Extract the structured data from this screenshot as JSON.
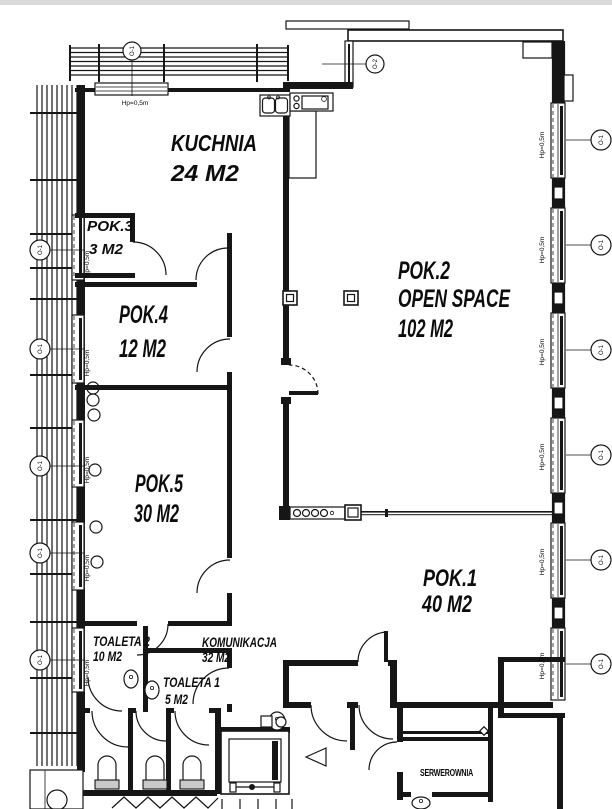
{
  "rooms": {
    "kuchnia": {
      "name": "KUCHNIA",
      "area": "24 M2"
    },
    "pok3": {
      "name": "POK.3",
      "area": "3 M2"
    },
    "pok4": {
      "name": "POK.4",
      "area": "12 M2"
    },
    "pok5": {
      "name": "POK.5",
      "area": "30 M2"
    },
    "pok2": {
      "name": "POK.2",
      "subtitle": "OPEN SPACE",
      "area": "102 M2"
    },
    "pok1": {
      "name": "POK.1",
      "area": "40 M2"
    },
    "toaleta2": {
      "name": "TOALETA 2",
      "area": "10 M2"
    },
    "komunikacja": {
      "name": "KOMUNIKACJA",
      "area": "32 M2"
    },
    "toaleta1": {
      "name": "TOALETA 1",
      "area": "5 M2"
    },
    "serwerownia": {
      "name": "SERWEROWNIA"
    }
  },
  "annotations": {
    "sill_height_label": "Hp=0,5m",
    "window_tag_primary": "O-1",
    "window_tag_secondary": "O-2"
  },
  "colors": {
    "line": "#161616",
    "paper": "#ffffff"
  }
}
